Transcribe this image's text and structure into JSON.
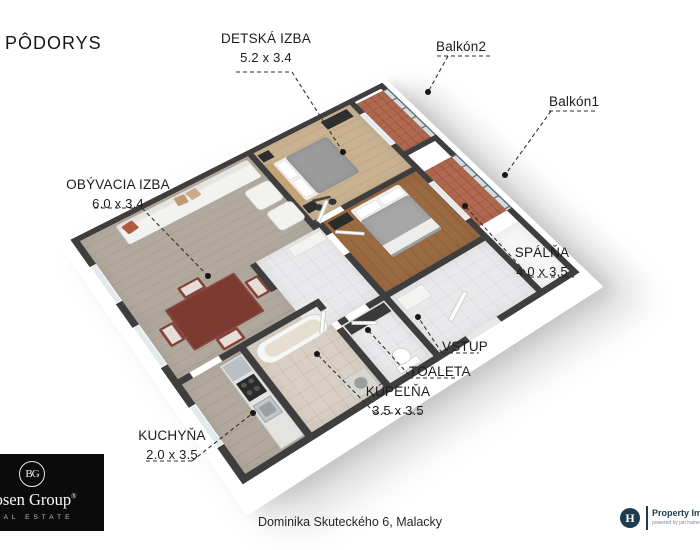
{
  "title": "PÔDORYS",
  "address": "Dominika Skuteckého 6, Malacky",
  "labels": {
    "detska": {
      "name": "DETSKÁ IZBA",
      "dims": "5.2 x 3.4"
    },
    "balkon2": {
      "name": "Balkón2"
    },
    "balkon1": {
      "name": "Balkón1"
    },
    "obyvacia": {
      "name": "OBÝVACIA IZBA",
      "dims": "6.0 x 3.4"
    },
    "spalna": {
      "name": "SPÁLŇA",
      "dims": "4.0 x 3.5"
    },
    "vstup": {
      "name": "VSTUP"
    },
    "toaleta": {
      "name": "TOALETA"
    },
    "kupelna": {
      "name": "KÚPEĽŇA",
      "dims": "3.5 x 3.5"
    },
    "kuchyna": {
      "name": "KUCHYŇA",
      "dims": "2.0 x 3.5"
    }
  },
  "agency": {
    "monogram": "BG",
    "name": "Bosen Group",
    "reg": "®",
    "tagline": "REAL ESTATE"
  },
  "credit": {
    "initial": "H",
    "name": "Property Imaging",
    "sub": "powered by jan hamersky"
  },
  "colors": {
    "wall": "#3e3e3e",
    "floor_living": "#b2a99e",
    "floor_children": "#c9b291",
    "floor_bedroom": "#9a6a42",
    "floor_balcony": "#b26a50",
    "floor_bath": "#d9cfc2",
    "floor_hall": "#e9e9eb",
    "accent_table": "#7c3a30",
    "brand_navy": "#1e3c50"
  }
}
